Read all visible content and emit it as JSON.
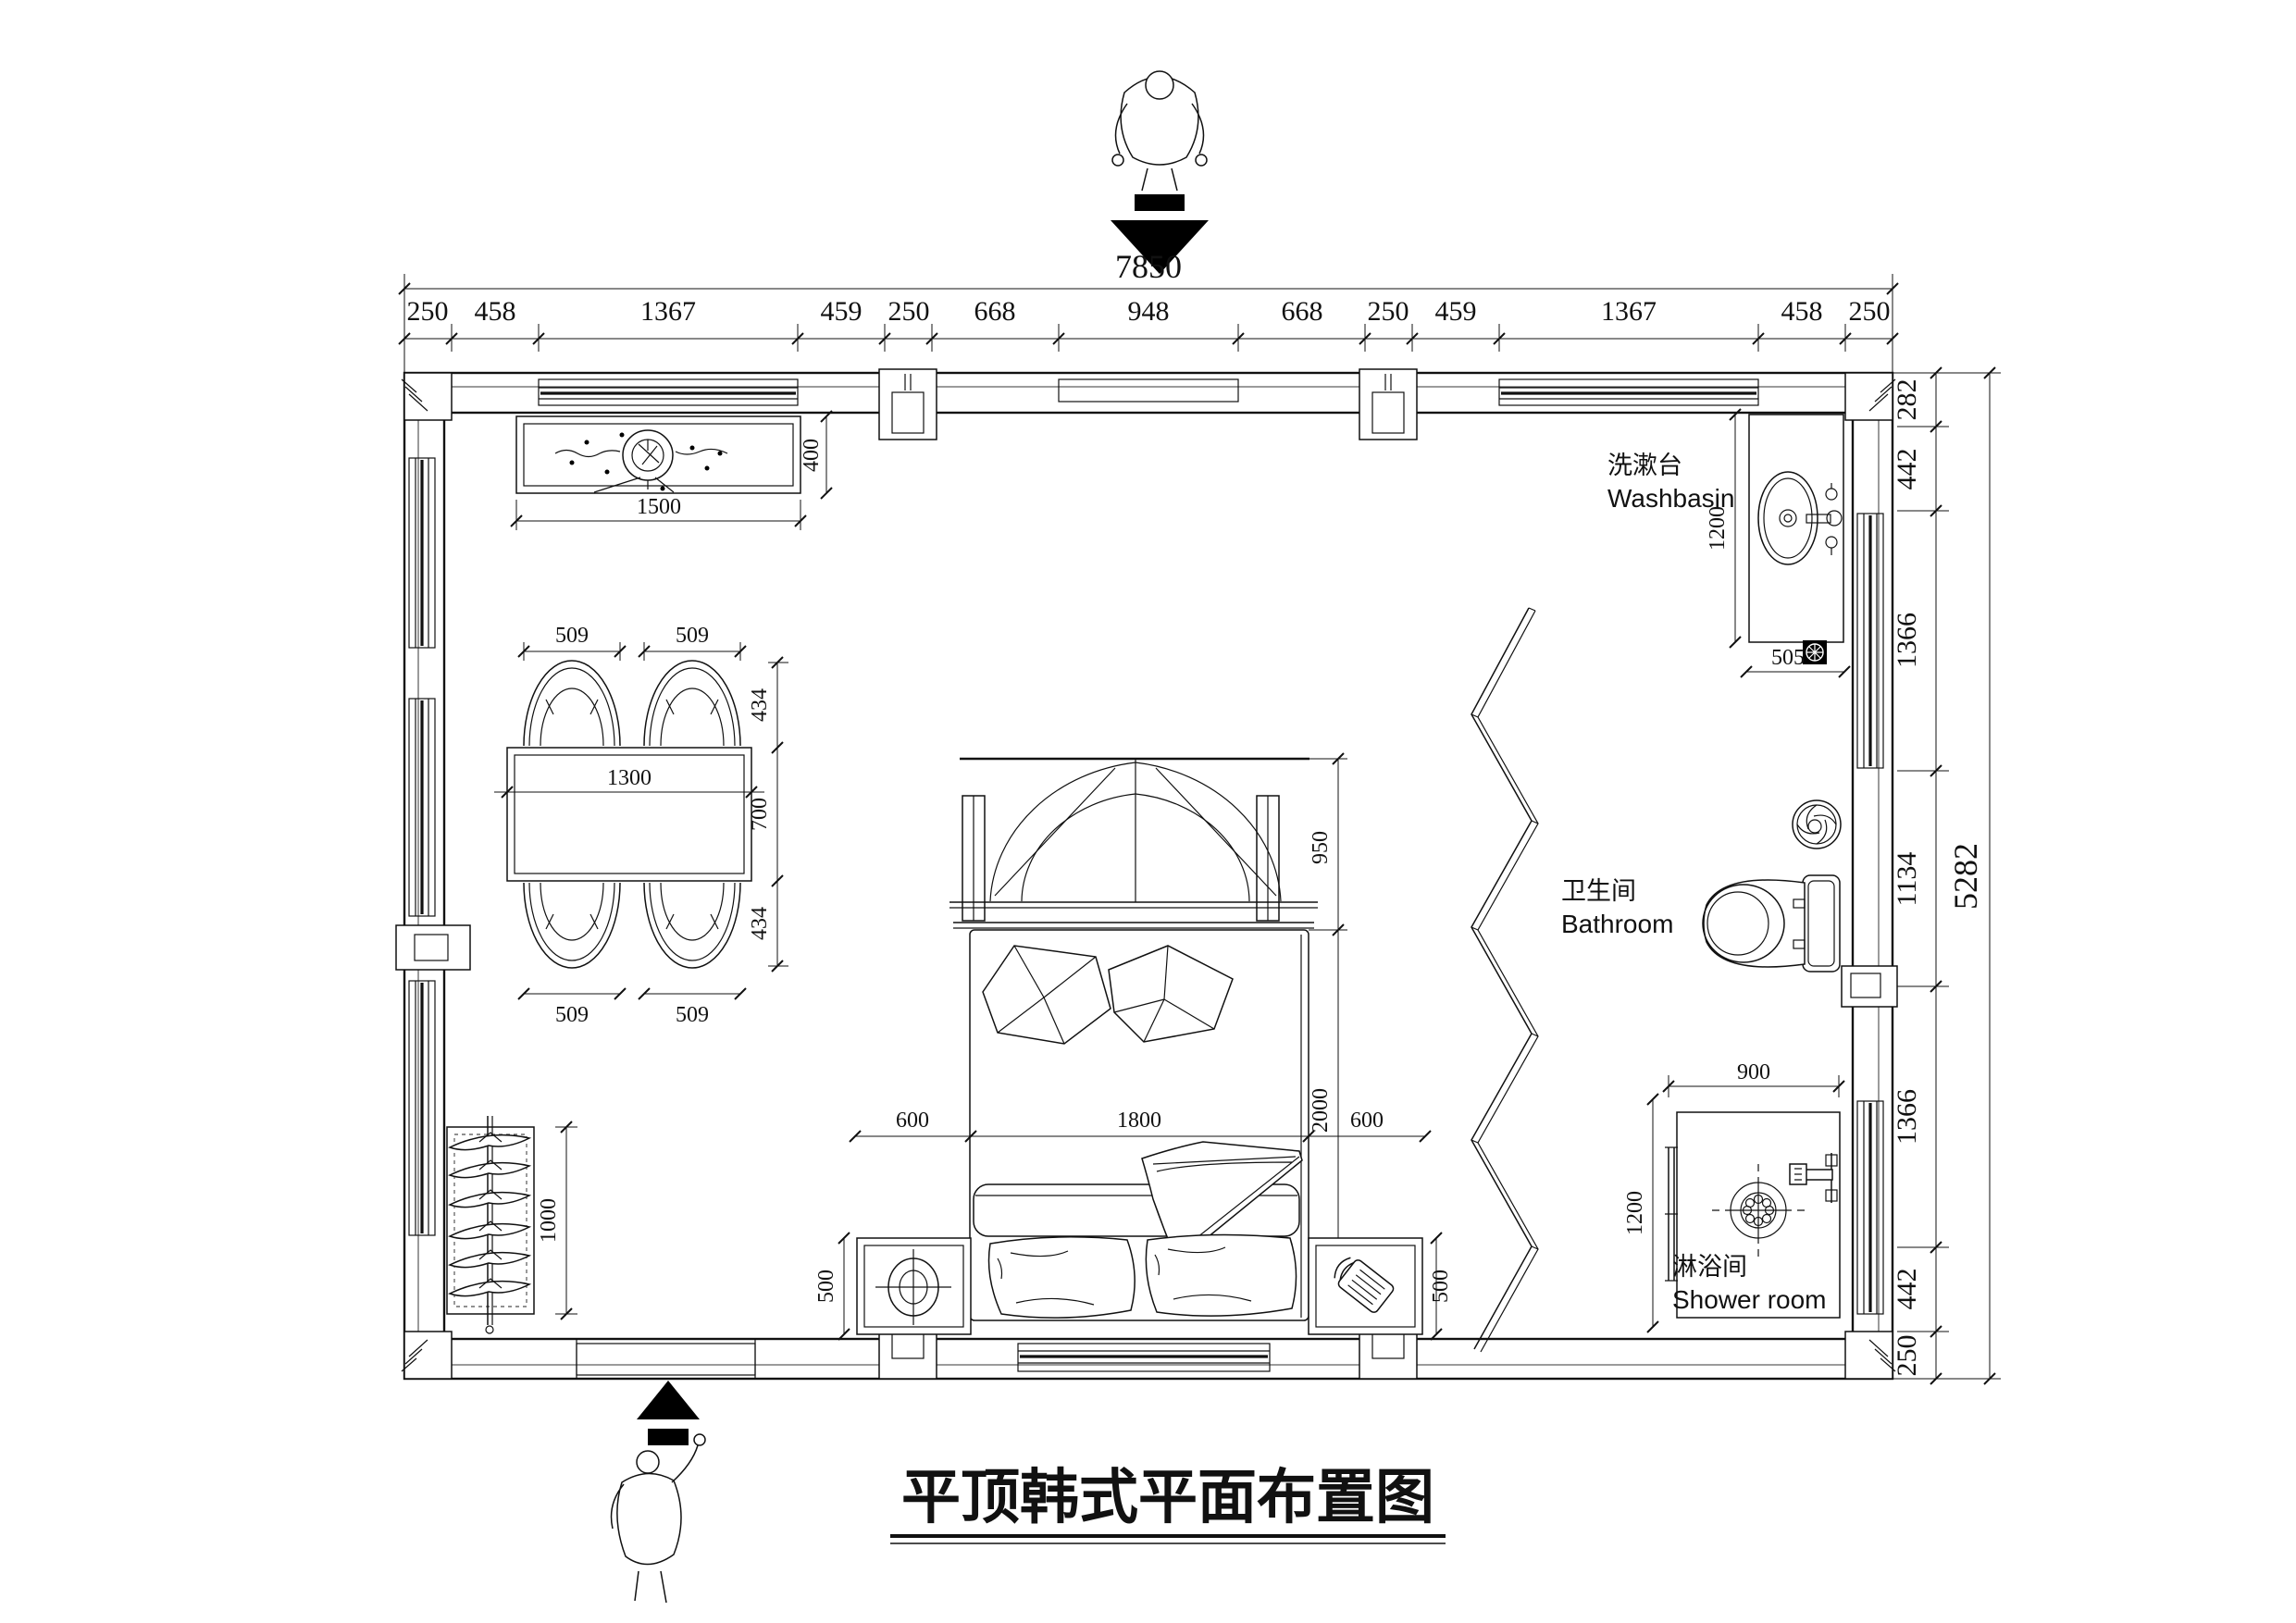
{
  "title": "平顶韩式平面布置图",
  "dimensions": {
    "overall_width": "7850",
    "overall_height": "5282",
    "top_chain": [
      "250",
      "458",
      "1367",
      "459",
      "250",
      "668",
      "948",
      "668",
      "250",
      "459",
      "1367",
      "458",
      "250"
    ],
    "right_chain": [
      "282",
      "442",
      "1366",
      "1134",
      "1366",
      "442",
      "250"
    ]
  },
  "fixtures": {
    "counter": {
      "width": "1500",
      "depth": "400"
    },
    "dining": {
      "table_width": "1300",
      "table_depth": "700",
      "chair_widths": [
        "509",
        "509",
        "509",
        "509"
      ],
      "chair_depths": [
        "434",
        "434"
      ]
    },
    "bed": {
      "headboard_depth": "950",
      "width": "1800",
      "length": "2000",
      "left_side": "600",
      "right_side": "600",
      "nightstand_left": "500",
      "nightstand_right": "500"
    },
    "wardrobe": {
      "width": "1000"
    },
    "washbasin": {
      "label_zh": "洗漱台",
      "label_en": "Washbasin",
      "length": "1200",
      "depth": "505"
    },
    "bathroom": {
      "label_zh": "卫生间",
      "label_en": "Bathroom"
    },
    "shower": {
      "label_zh": "淋浴间",
      "label_en": "Shower room",
      "width": "900",
      "depth": "1200"
    }
  }
}
